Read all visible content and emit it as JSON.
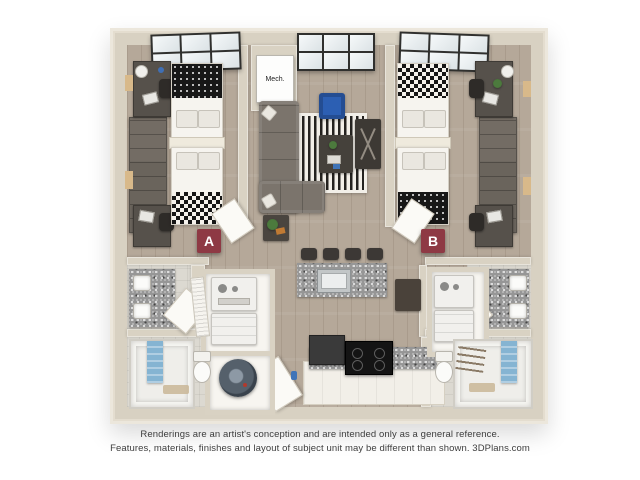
{
  "floorplan": {
    "unit_label_a": "A",
    "unit_label_b": "B",
    "mech_label": "Mech.",
    "colors": {
      "badge": "#8e3944",
      "wall": "#d9d2c3",
      "floor_wood": "#b5a899",
      "rug_stripe_dark": "#24221f",
      "accent_chair_blue": "#2c5fb3",
      "towel_blue": "#85b4d2",
      "granite": "#969696"
    }
  },
  "disclaimer": {
    "line1": "Renderings are an artist's conception and are intended only as a general reference.",
    "line2": "Features, materials, finishes and layout of subject unit may be different than shown. 3DPlans.com"
  }
}
